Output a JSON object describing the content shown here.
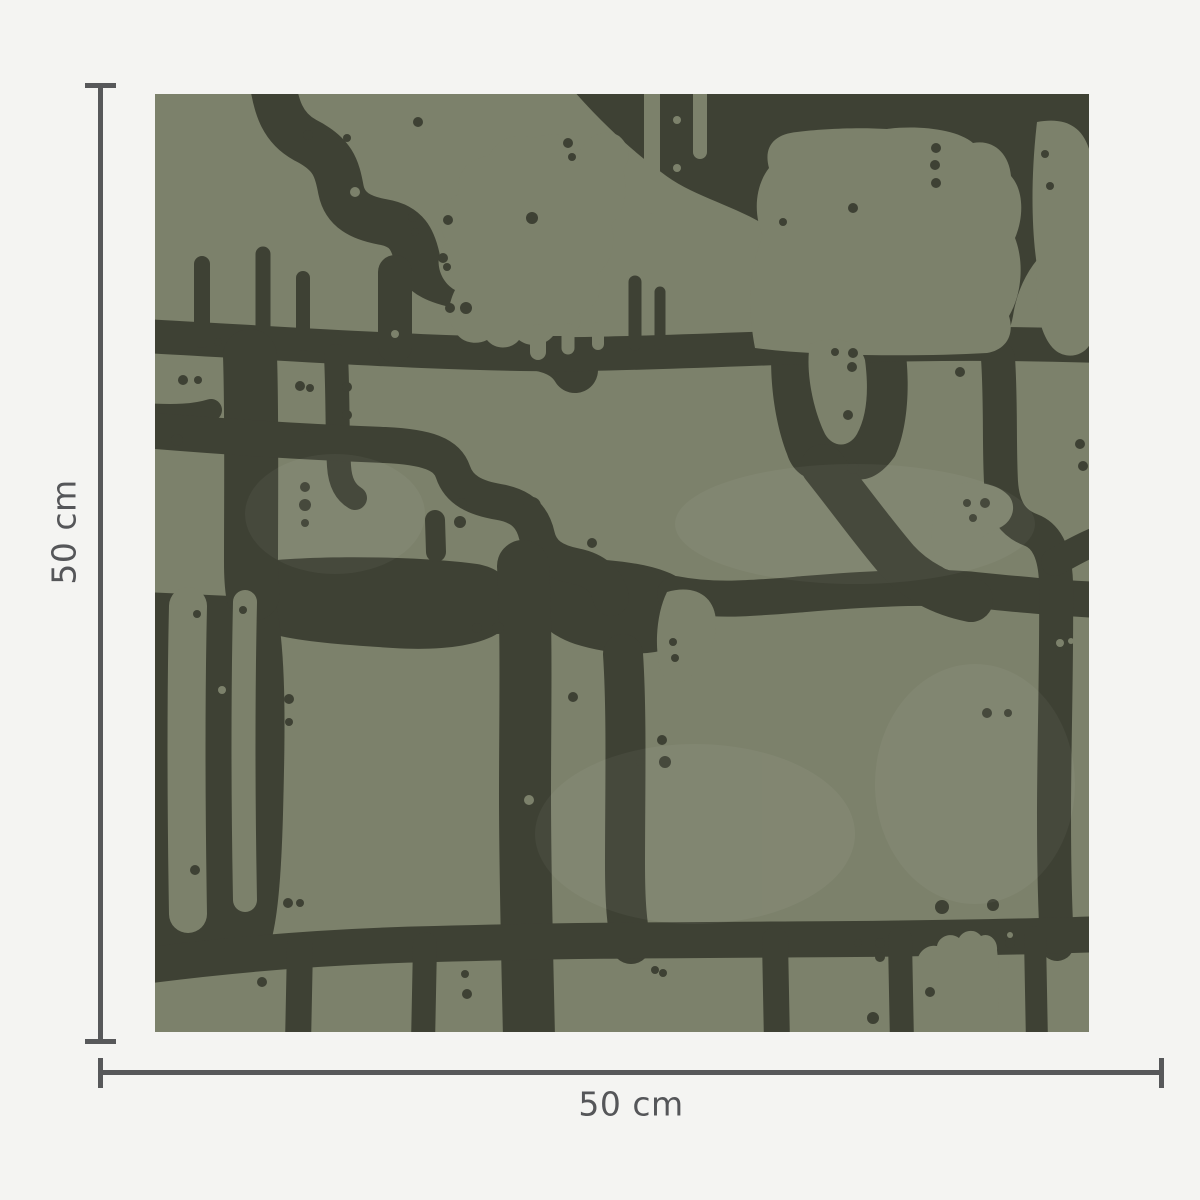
{
  "page": {
    "background_color": "#f4f4f2"
  },
  "swatch": {
    "description": "Square wallpaper swatch with abstract organic blob pattern in olive green and dark charcoal",
    "pattern_colors": {
      "base_green": "#7c816b",
      "shape_dark": "#3e4134"
    }
  },
  "dimensions": {
    "height_label": "50 cm",
    "width_label": "50 cm",
    "line_color": "#57585a",
    "text_color": "#555659"
  }
}
